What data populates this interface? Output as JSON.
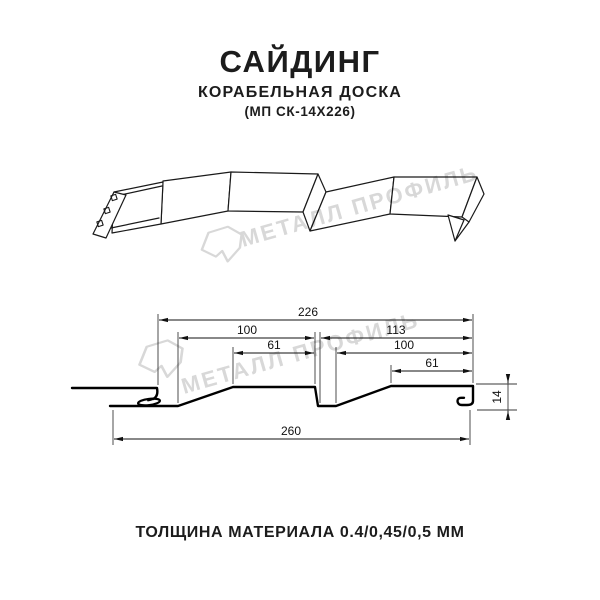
{
  "header": {
    "title": "САЙДИНГ",
    "subtitle": "КОРАБЕЛЬНАЯ ДОСКА",
    "model": "(МП СК-14Х226)"
  },
  "watermark": {
    "brand": "МЕТАЛЛ ПРОФИЛЬ",
    "logo": "metall-profil-logo",
    "color": "#d8d8d8"
  },
  "footer": {
    "thickness": "ТОЛЩИНА МАТЕРИАЛА 0.4/0,45/0,5 ММ"
  },
  "diagram": {
    "units": "mm",
    "dims": {
      "total_top": "226",
      "left_pitch": "100",
      "right_pitch": "113",
      "left_flat": "61",
      "right_inner": "100",
      "right_flat": "61",
      "overall_width": "260",
      "profile_height": "14"
    }
  },
  "colors": {
    "ink": "#1c1c1c",
    "line": "#000000",
    "watermark": "#d8d8d8"
  }
}
